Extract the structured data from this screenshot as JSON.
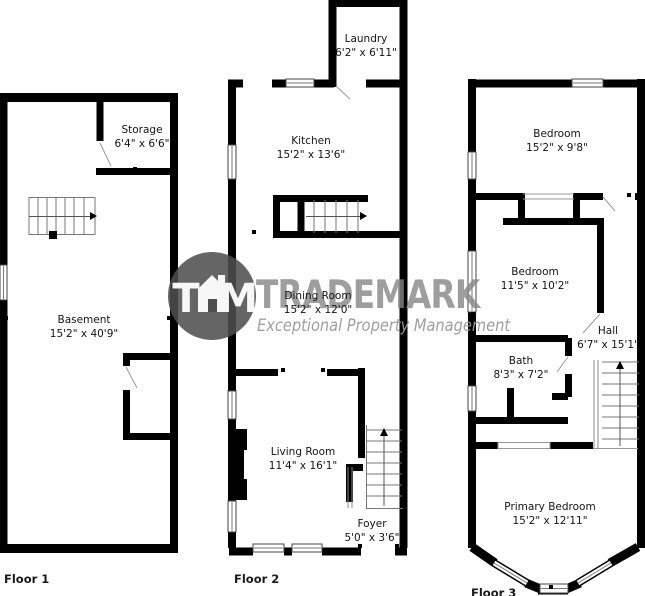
{
  "colors": {
    "wall": "#000000",
    "background": "#ffffff",
    "watermark_circle": "#4e4e4e",
    "watermark_text": "#868686",
    "watermark_tagline": "#9a9a9a"
  },
  "watermark": {
    "brand": "TRADEMARK",
    "tagline": "Exceptional Property Management",
    "monogram": [
      "T",
      "M"
    ]
  },
  "floors": [
    {
      "label": "Floor 1",
      "rooms": [
        {
          "name": "Storage",
          "dims": "6'4\" x 6'6\""
        },
        {
          "name": "Basement",
          "dims": "15'2\" x 40'9\""
        }
      ]
    },
    {
      "label": "Floor 2",
      "rooms": [
        {
          "name": "Laundry",
          "dims": "6'2\" x 6'11\""
        },
        {
          "name": "Kitchen",
          "dims": "15'2\" x 13'6\""
        },
        {
          "name": "Dining Room",
          "dims": "15'2\" x 12'0\""
        },
        {
          "name": "Living Room",
          "dims": "11'4\" x 16'1\""
        },
        {
          "name": "Foyer",
          "dims": "5'0\" x 3'6\""
        }
      ]
    },
    {
      "label": "Floor 3",
      "rooms": [
        {
          "name": "Bedroom",
          "dims": "15'2\" x 9'8\""
        },
        {
          "name": "Bedroom",
          "dims": "11'5\" x 10'2\""
        },
        {
          "name": "Hall",
          "dims": "6'7\" x 15'1\""
        },
        {
          "name": "Bath",
          "dims": "8'3\" x 7'2\""
        },
        {
          "name": "Primary Bedroom",
          "dims": "15'2\" x 12'11\""
        }
      ]
    }
  ]
}
